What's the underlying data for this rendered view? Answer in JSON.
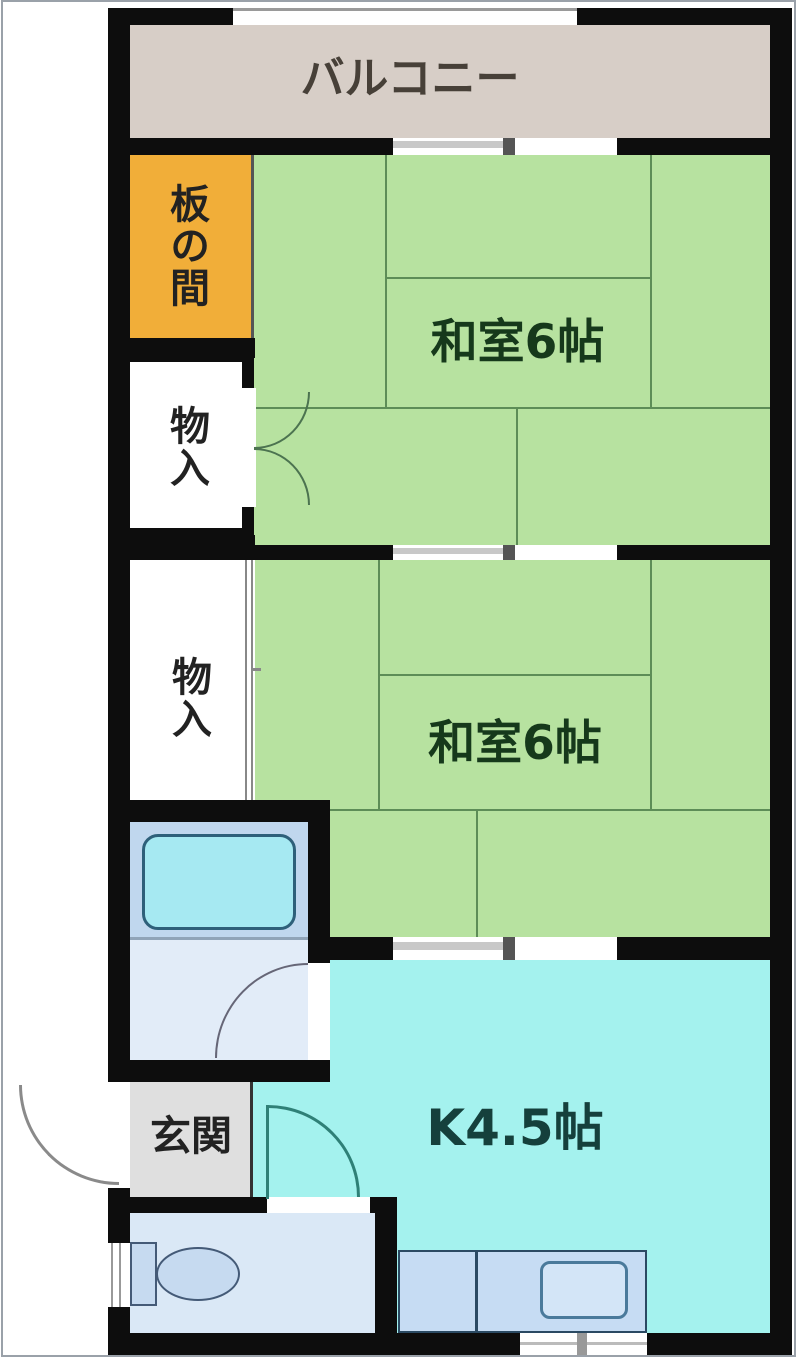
{
  "plan_title": "2K apartment floor plan",
  "rooms": {
    "balcony": {
      "label": "バルコニー"
    },
    "itanoma": {
      "label": "板の間"
    },
    "washitsu_upper": {
      "label": "和室6帖"
    },
    "washitsu_lower": {
      "label": "和室6帖"
    },
    "closet_upper": {
      "label": "物入"
    },
    "closet_lower": {
      "label": "物入"
    },
    "genkan": {
      "label": "玄関"
    },
    "kitchen": {
      "label": "K4.5帖"
    }
  },
  "colors": {
    "wall": "#0d0d0d",
    "balcony_bg": "#d7cec7",
    "itanoma_bg": "#f1ae39",
    "tatami_bg": "#b7e2a0",
    "tatami_line": "#5d8d57",
    "kitchen_bg": "#a4f2ee",
    "bath_bg": "#c0d7ee",
    "washroom_bg": "#e2ecf8",
    "toilet_bg": "#dae8f6",
    "genkan_bg": "#dfdfdf",
    "closet_bg": "#ffffff",
    "counter_bg": "#c6dcf3",
    "tub_bg": "#a6e9f2",
    "fixture_line": "#445a77",
    "label_green": "#16391b",
    "label_teal": "#15403c",
    "label_dark": "#222222",
    "balcony_text": "#474038",
    "door_green": "#4c7350",
    "door_teal": "#2f8077",
    "door_gray": "#8a8a8a",
    "window_gray": "#c8c8c8",
    "mullion": "#555555",
    "frame": "#9aa1a9"
  }
}
